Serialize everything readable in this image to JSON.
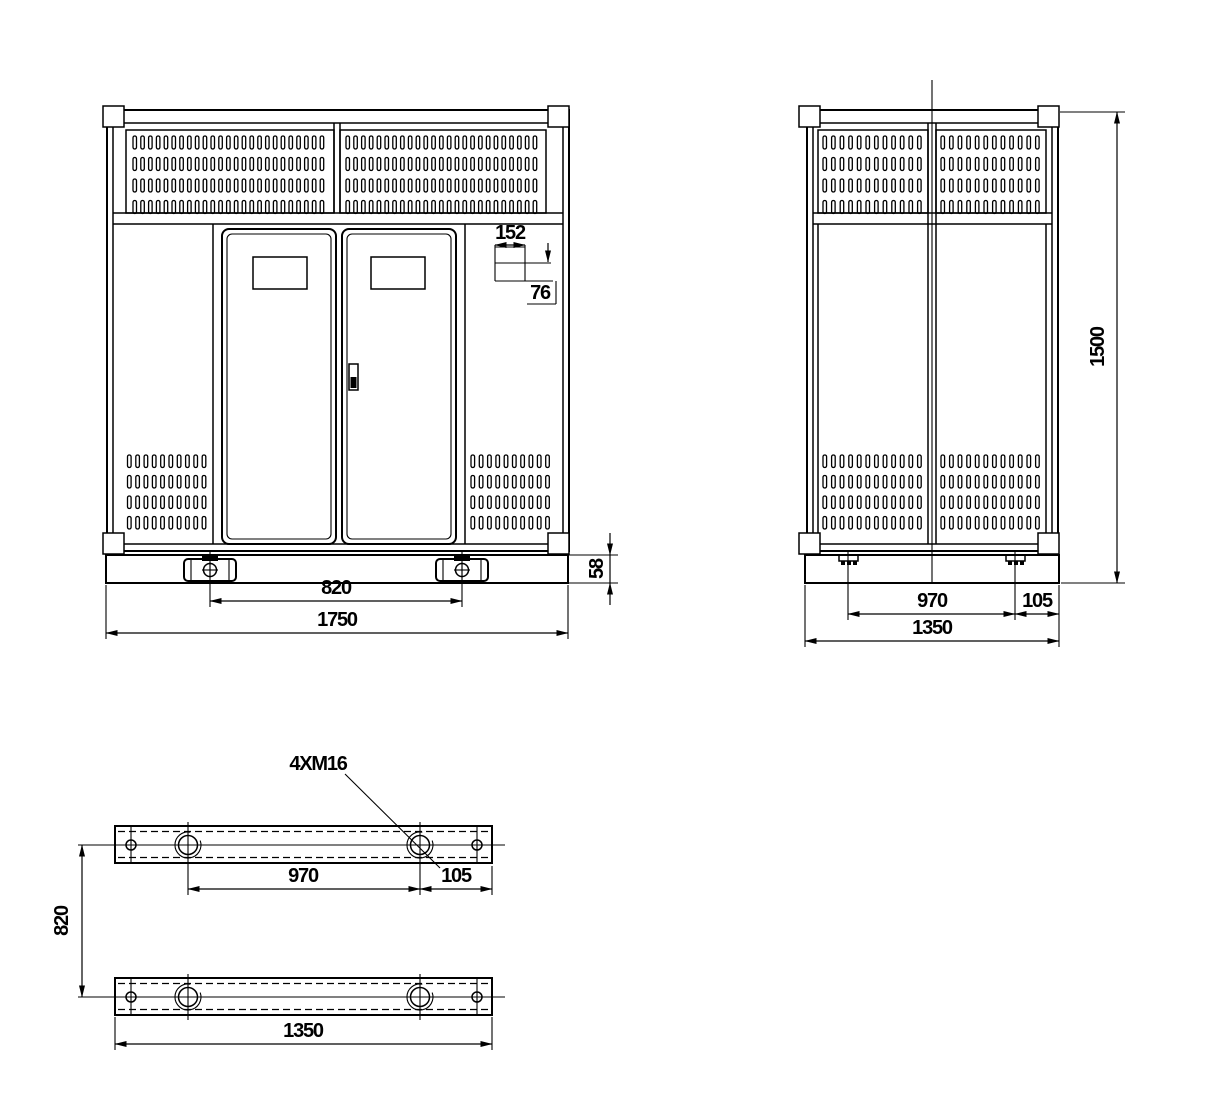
{
  "page": {
    "background": "#ffffff",
    "line_color": "#000000"
  },
  "front_view": {
    "dims": {
      "total_width": "1750",
      "foot_spacing": "820",
      "base_height": "58",
      "louver_width": "152",
      "louver_height": "76"
    }
  },
  "side_view": {
    "dims": {
      "total_height": "1500",
      "foot_spacing": "970",
      "foot_edge_offset": "105",
      "total_depth": "1350"
    }
  },
  "base_plan": {
    "thread_callout": "4XM16",
    "dims": {
      "hole_spacing": "970",
      "hole_edge_offset": "105",
      "rail_length": "1350",
      "rail_spacing": "820"
    }
  }
}
